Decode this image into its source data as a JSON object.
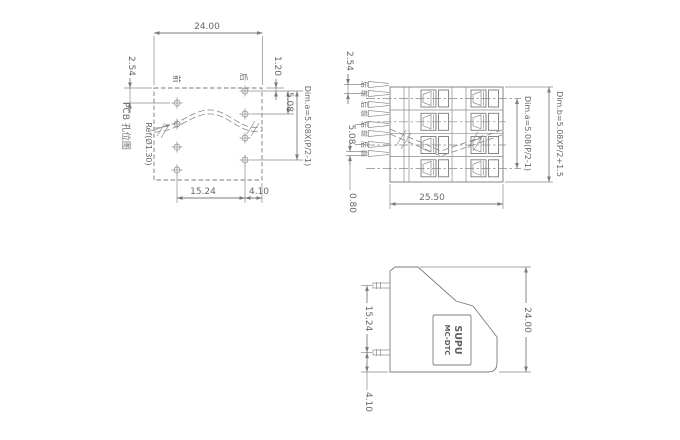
{
  "drawing": {
    "pcb_view": {
      "title": "PCB 孔位图",
      "ref_label": "Ref(Ø1.30)",
      "front_col_label": "前",
      "back_col_label": "后",
      "dim_width": "24.00",
      "dim_row_stagger": "2.54",
      "dim_top_offset": "1.20",
      "dim_hole_pitch": "5.08",
      "dim_span_formula": "Dim.a=5.08X(P/2-1)",
      "dim_col_spacing": "15.24",
      "dim_edge_offset": "4.10"
    },
    "front_view": {
      "pin_labels": [
        "后",
        "前",
        "后",
        "前",
        "后",
        "前",
        "后",
        "前"
      ],
      "dim_pin_stagger": "2.54",
      "dim_row_pitch": "5.08",
      "dim_pin_thickness": "0.80",
      "dim_body_width": "25.50",
      "dim_span_formula": "Dim.a=5.08(P/2-1)",
      "dim_height_formula": "Dim.b=5.08XP/2+1.5"
    },
    "side_view": {
      "brand_line1": "SUPU",
      "brand_line2": "MC-DTC",
      "dim_pin_spacing": "15.24",
      "dim_body_height": "24.00",
      "dim_pin_bottom_offset": "4.10"
    },
    "colors": {
      "line": "#7b7b7b",
      "text": "#676767",
      "background": "#ffffff"
    }
  }
}
